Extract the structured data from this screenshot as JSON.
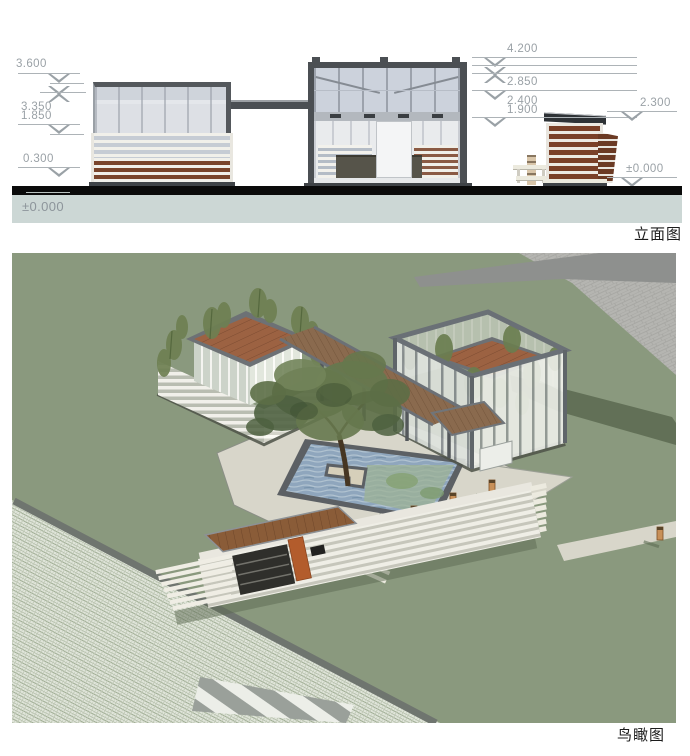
{
  "sheet": {
    "width": 690,
    "height": 756
  },
  "elevation": {
    "title": "立面图",
    "left_markers": {
      "m1": "3.600",
      "m2": "3.350",
      "m3": "1.850",
      "m4": "0.300",
      "ground": "±0.000"
    },
    "right_markers": {
      "m1": "4.200",
      "m2": "2.850",
      "m3": "2.400",
      "m4": "1.900",
      "side": "2.300",
      "ground": "±0.000"
    }
  },
  "aerial": {
    "title": "鸟瞰图"
  },
  "colors": {
    "ground_band": "#0b0b0b",
    "ground_fill": "#ccd7d5",
    "dimension_gray": "#9aa1a6",
    "frame_dark": "#4b4f53",
    "glass": "#dfe2e6",
    "wood_brown": "#7a452c",
    "slat_white": "#f1f0ea",
    "lawn_green": "#8a997e",
    "paving_gray": "#b4b4b0",
    "road_gray": "#8e908e",
    "water_blue": "#8fa6bd",
    "roof_brown": "#9c6242",
    "pergola_wood": "#8a6a4e",
    "bollard_orange": "#c89058",
    "shadow_green": "#5e6c54",
    "grid_paver": "#dfe4da"
  }
}
